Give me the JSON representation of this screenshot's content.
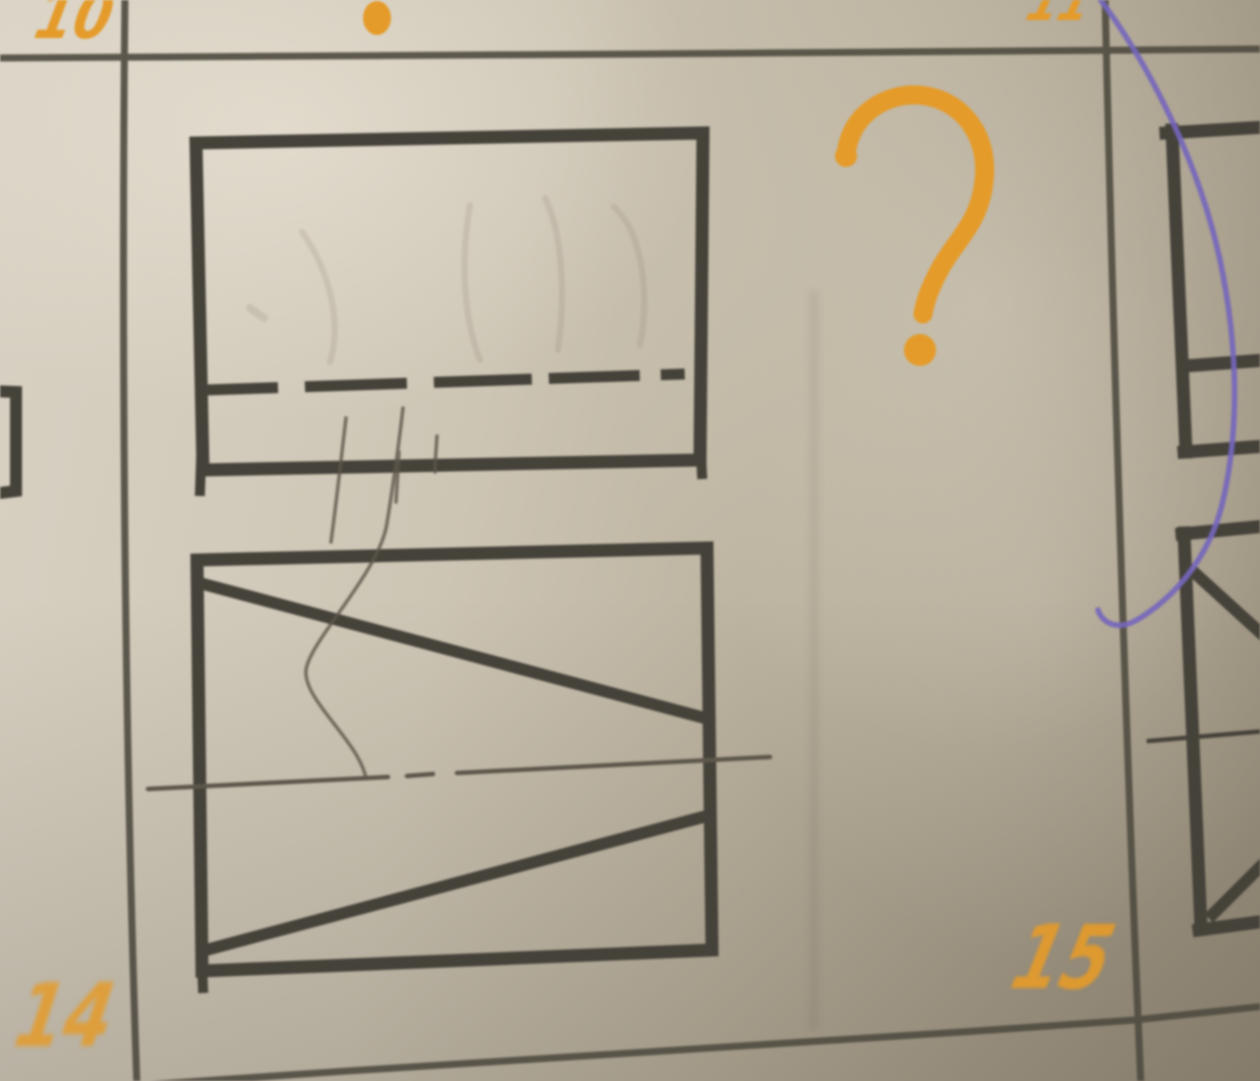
{
  "labels": {
    "cell_top_left": "10",
    "cell_top_right": "11",
    "cell_bottom_left": "14",
    "cell_bottom_right": "15"
  },
  "annotations": {
    "question_mark": "?"
  },
  "colors": {
    "orange_marker": "#e49b2a",
    "purple_pen": "#7466bd",
    "ink": "#45423a",
    "pencil": "#5d574b",
    "grid_line": "#514d42"
  }
}
